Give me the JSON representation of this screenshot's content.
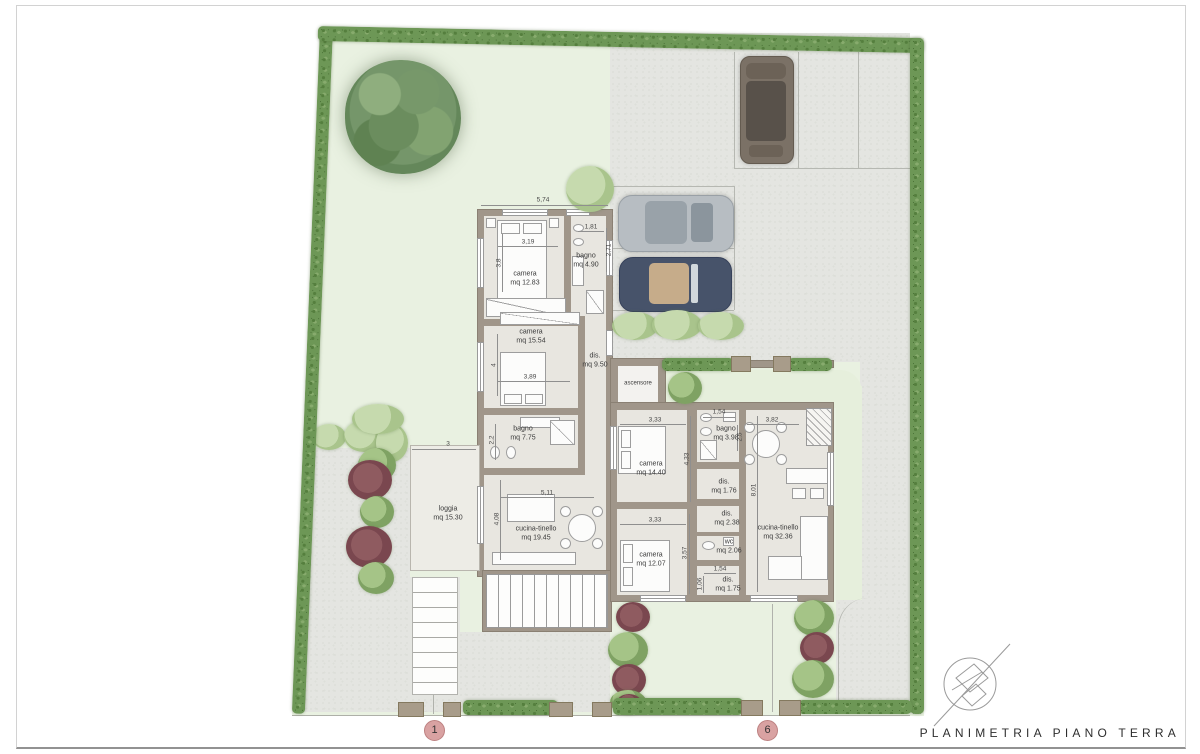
{
  "title": "PLANIMETRIA PIANO TERRA",
  "markers": {
    "unit1": "1",
    "unit6": "6"
  },
  "unit1": {
    "camera1": {
      "name": "camera",
      "area": "mq 12.83"
    },
    "bagno1": {
      "name": "bagno",
      "area": "mq 4.90"
    },
    "camera2": {
      "name": "camera",
      "area": "mq 15.54"
    },
    "dis": {
      "name": "dis.",
      "area": "mq 9.50"
    },
    "bagno2": {
      "name": "bagno",
      "area": "mq 7.75"
    },
    "cucina": {
      "name": "cucina-tinello",
      "area": "mq 19.45"
    },
    "loggia": {
      "name": "loggia",
      "area": "mq 15.30"
    },
    "dims": {
      "top": "5,74",
      "camera1_w": "3,19",
      "camera1_h": "3,8",
      "bagno1_w": "1,81",
      "bagno1_h": "2,71",
      "camera2_w": "3,89",
      "camera2_h": "4",
      "bagno2_h": "2,2",
      "cucina_w": "5,11",
      "cucina_h": "4,08",
      "loggia_w": "3"
    }
  },
  "unit6": {
    "ascensore": {
      "name": "ascensore"
    },
    "camera1": {
      "name": "camera",
      "area": "mq 14.40"
    },
    "bagno": {
      "name": "bagno",
      "area": "mq 3.98"
    },
    "dis1": {
      "name": "dis.",
      "area": "mq 1.76"
    },
    "camera2": {
      "name": "camera",
      "area": "mq 12.07"
    },
    "dis2": {
      "name": "dis.",
      "area": "mq 2.38"
    },
    "wc": {
      "name": "wc",
      "area": "mq 2.06"
    },
    "dis3": {
      "name": "dis.",
      "area": "mq 1.75"
    },
    "cucina": {
      "name": "cucina-tinello",
      "area": "mq 32.36"
    },
    "dims": {
      "camera1_w": "3,33",
      "bagno_w": "1,54",
      "bagno_h": "2,5",
      "camera1_h": "4,33",
      "camera2_w": "3,33",
      "camera2_h": "3,57",
      "dis3_w": "1,54",
      "dis3_h": "1,06",
      "cucina_h": "8,01",
      "cucina_w": "3,82"
    }
  }
}
